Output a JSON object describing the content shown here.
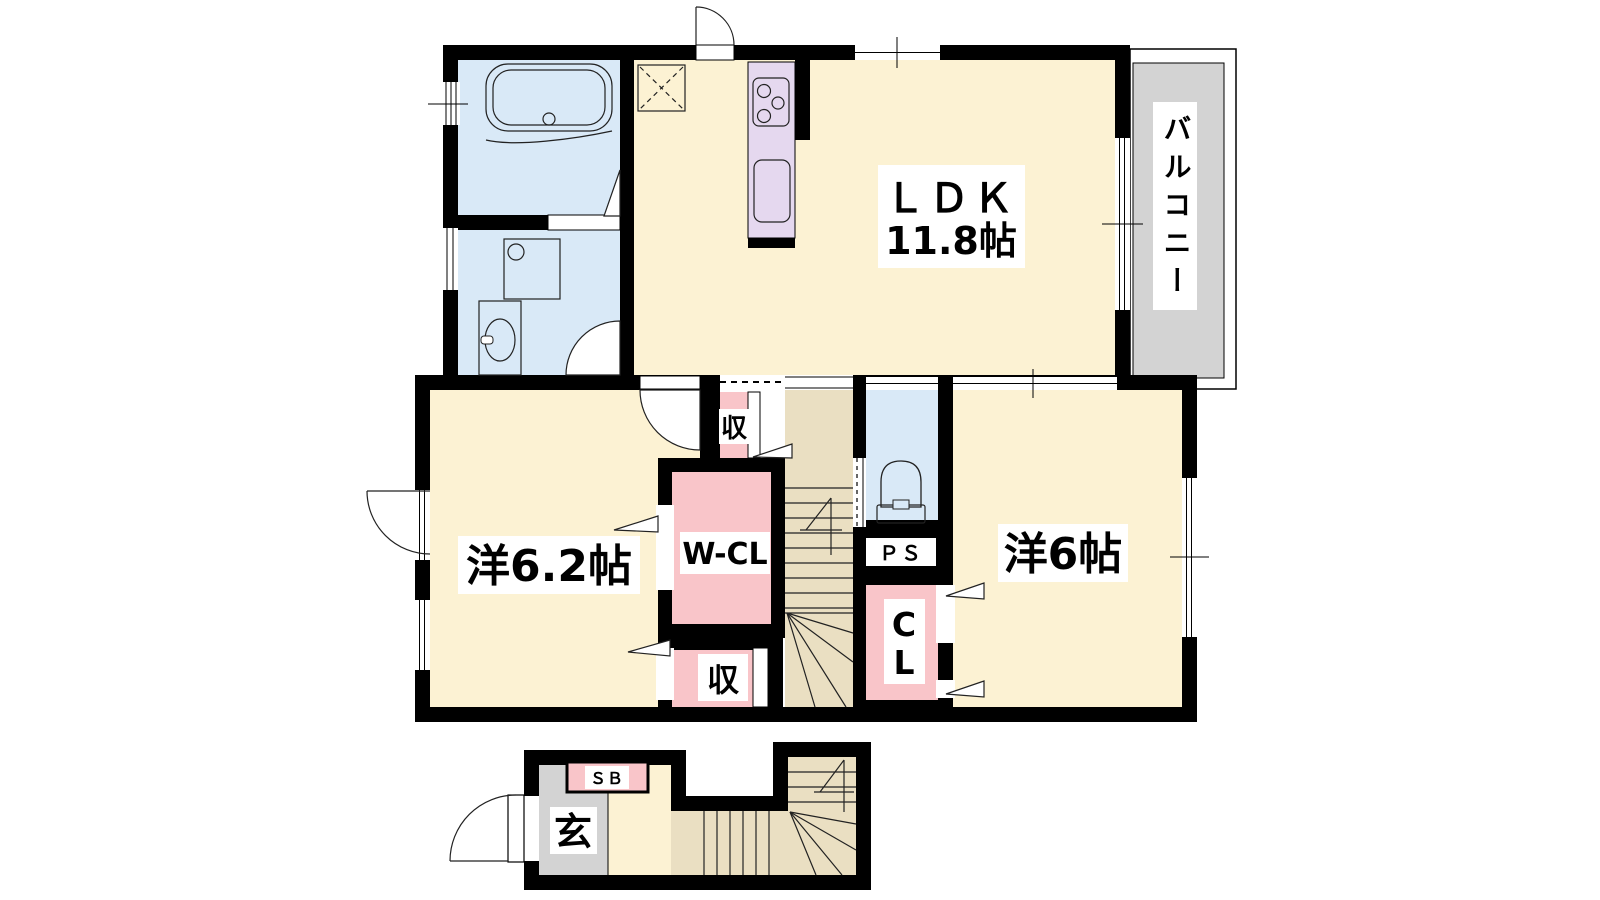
{
  "diagram_type": "floor-plan",
  "rooms": {
    "ldk": {
      "name": "ＬＤＫ",
      "size": "11.8帖"
    },
    "western_6_2": {
      "name": "洋6.2帖"
    },
    "western_6": {
      "name": "洋6帖"
    },
    "balcony": {
      "name": "バルコニー"
    },
    "walk_in_closet": {
      "name": "W-CL"
    },
    "closet": {
      "line1": "C",
      "line2": "L"
    },
    "pipe_space": {
      "name": "ＰＳ"
    },
    "storage_upper": {
      "name": "収"
    },
    "storage_lower": {
      "name": "収"
    },
    "entrance": {
      "name": "玄"
    },
    "shoe_box": {
      "name": "ＳＢ"
    }
  },
  "colors": {
    "wall": "#000000",
    "floor_cream": "#FCF2D3",
    "stairs_tan": "#EADFC2",
    "water_blue": "#D9E9F7",
    "closet_pink": "#F9C5C9",
    "kitchen_lavender": "#E5D8EF",
    "outdoor_gray": "#D3D3D3",
    "label_bg": "#FFFFFF"
  },
  "icons": [
    "bathtub-icon",
    "washer-pan-icon",
    "washbasin-icon",
    "toilet-icon",
    "stove-icon",
    "kitchen-sink-icon",
    "fridge-space-icon",
    "stairs-up-arrow-icon",
    "door-swing-icon",
    "window-icon",
    "sliding-door-icon",
    "folding-door-arrow-icon"
  ]
}
